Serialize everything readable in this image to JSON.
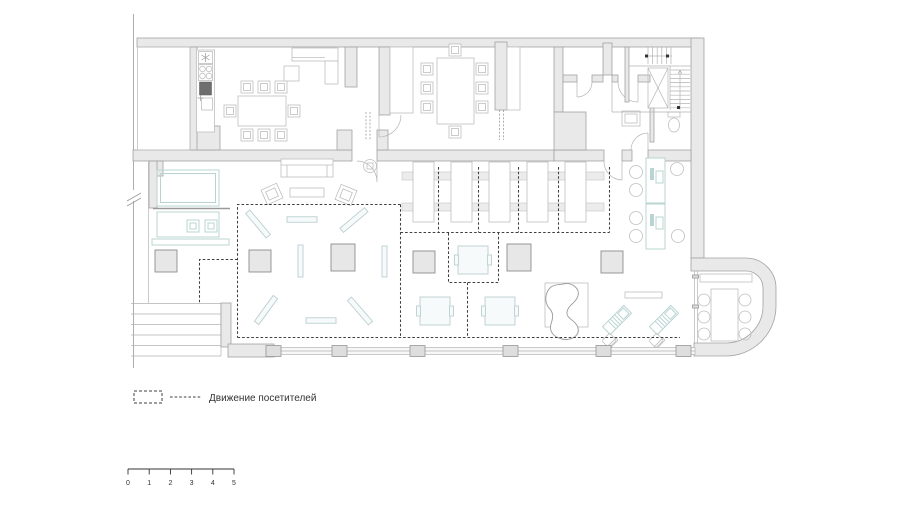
{
  "legend": {
    "zone_symbol": "dashed-rectangle",
    "line_symbol": "dashed-line",
    "label": "Движение посетителей"
  },
  "scale_bar": {
    "ticks": [
      "0",
      "1",
      "2",
      "3",
      "4",
      "5"
    ]
  },
  "colors": {
    "background": "#ffffff",
    "wall_fill": "#e9e9e9",
    "wall_stroke": "#a2a2a2",
    "furniture_stroke": "#bfbfbf",
    "accent_teal": "#b9d4d2",
    "column_stroke": "#8d8d8d",
    "visitor_path": "#3f3f3f",
    "text": "#333333"
  }
}
